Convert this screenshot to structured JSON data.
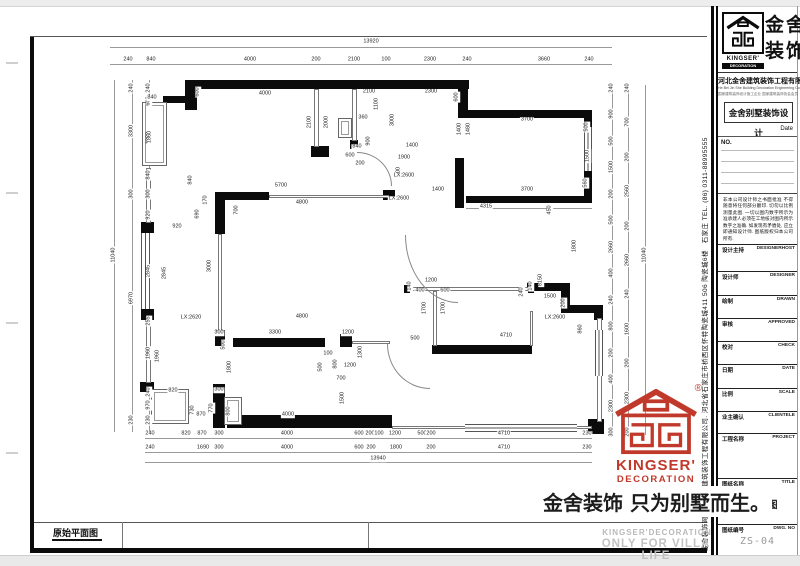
{
  "sheet": {
    "bottom_strip_label": "原始平面图"
  },
  "title_block": {
    "logo": {
      "cn_name": "金舍装饰",
      "en_name": "KINGSER'",
      "en_sub": "DECORATION"
    },
    "company_cn": "河北金舍建筑装饰工程有限公司",
    "company_en": "He Bei Jin She Building Decoration Engineering Co., Ltd",
    "company_sub": "国家建筑装饰设计施工企业 国家建筑装饰协会会员",
    "project_title": "金舍别墅装饰设计",
    "date_label": "Date",
    "no_label": "NO.",
    "disclaimer": "非本公司设计师之书面批准 不得随意将任何部分翻印. 切勿以比例测量此图. 一切以图内数字所示为准承建人必须在工地核对图内所示数字之准确. 如发现有矛盾处, 应立即通知设计师. 图纸版权归本公司所有.",
    "rows": [
      {
        "cn": "设计主持",
        "en": "DESIGNERHOST"
      },
      {
        "cn": "设计师",
        "en": "DESIGNER"
      },
      {
        "cn": "绘制",
        "en": "DRAWN"
      },
      {
        "cn": "审核",
        "en": "APPROVED"
      },
      {
        "cn": "校对",
        "en": "CHECK"
      },
      {
        "cn": "日期",
        "en": "DATE"
      },
      {
        "cn": "比例",
        "en": "SCALE"
      },
      {
        "cn": "业主确认",
        "en": "CLIENTELE"
      },
      {
        "cn": "工程名称",
        "en": "PROJECT"
      },
      {
        "cn": "图纸名称",
        "en": "TITLE"
      },
      {
        "cn": "图纸编号",
        "en": "DWG. NO"
      }
    ],
    "drawing_title": "原始平面图",
    "drawing_no": "ZS-04",
    "side_text": "金舍装饰网 河北金舍建筑装饰工程有限公司. 河北省石家庄市桥西区怀特陶瓷城411 506 陶瓷城6楼　石家庄 TEL. (86) 0311-88995555"
  },
  "stamp": {
    "en_name": "KINGSER'",
    "en_sub": "DECORATION",
    "registered": "®",
    "color": "#c0392b"
  },
  "slogan": {
    "cn": "金舍装饰 只为别墅而生。",
    "en1": "KINGSER'DECORATION",
    "en2": "ONLY FOR VILLA LIFE"
  },
  "plan": {
    "total_width_top": "13920",
    "top": [
      "240",
      "840",
      "4000",
      "200",
      "2100",
      "100",
      "2300",
      "240",
      "3660",
      "240"
    ],
    "bottom1": [
      "240",
      "820",
      "870",
      "300",
      "4000",
      "600",
      "200",
      "100",
      "1200",
      "500",
      "200",
      "4710",
      "230"
    ],
    "bottom2": [
      "240",
      "1690",
      "300",
      "4000",
      "600",
      "200",
      "1800",
      "200",
      "4710",
      "230"
    ],
    "total_width_bottom": "13940",
    "left_inner": [
      "240",
      "600",
      "1860",
      "840",
      "300",
      "920",
      "2845",
      "255",
      "1960",
      "970",
      "230"
    ],
    "left_mid": [
      "240",
      "3300",
      "300",
      "6970",
      "230"
    ],
    "total_height_left": "11040",
    "right_inner": [
      "240",
      "900",
      "500",
      "1500",
      "200",
      "500",
      "2660",
      "400",
      "240",
      "800",
      "200",
      "400",
      "2300",
      "300"
    ],
    "right_mid": [
      "240",
      "700",
      "200",
      "2560",
      "200",
      "2660",
      "240",
      "1600",
      "200",
      "2300",
      "200"
    ],
    "total_height_right": "11040",
    "idims": [
      "4000",
      "840",
      "600",
      "1860",
      "840",
      "2100",
      "2000",
      "2100",
      "2300",
      "1100",
      "360",
      "3000",
      "900",
      "840",
      "1400",
      "1900",
      "1000",
      "LX:2600",
      "LX:2600",
      "600",
      "1400",
      "1480",
      "3700",
      "500",
      "1500",
      "560",
      "3700",
      "1400",
      "4315",
      "5700",
      "4800",
      "700",
      "170",
      "690",
      "920",
      "3000",
      "2845",
      "LX:2620",
      "300",
      "500",
      "4800",
      "3300",
      "1200",
      "1800",
      "1960",
      "820",
      "240",
      "730",
      "870",
      "770",
      "300",
      "800",
      "4000",
      "100",
      "500",
      "800",
      "1200",
      "700",
      "1500",
      "1300",
      "1200",
      "140",
      "400",
      "600",
      "140",
      "1700",
      "1700",
      "500",
      "4710",
      "8150",
      "240",
      "1500",
      "200",
      "860",
      "LX:2600",
      "1800",
      "450",
      "600",
      "200"
    ]
  }
}
